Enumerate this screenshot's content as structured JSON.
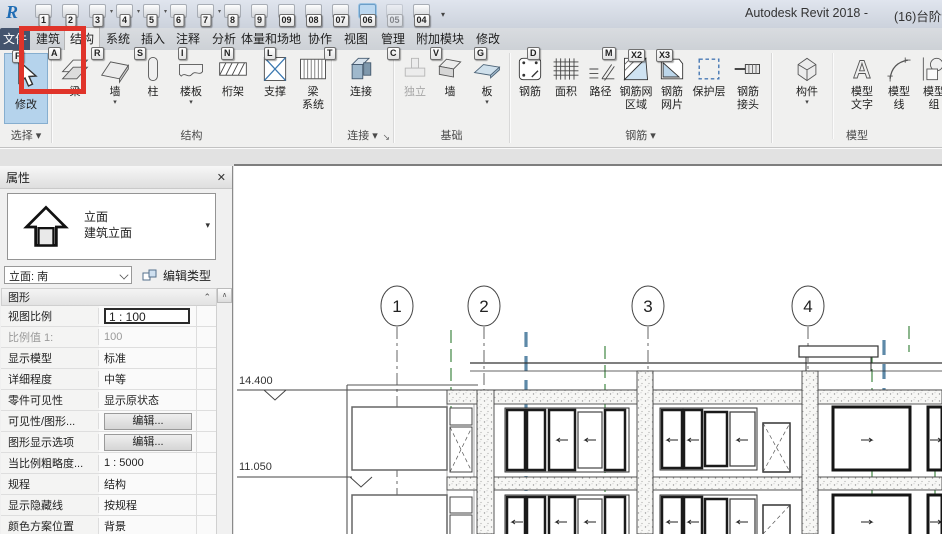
{
  "glyphs": {
    "dd": "▾",
    "up": "∧",
    "collapse": "⌃",
    "close": "✕",
    "launcher": "↘",
    "overflow": "▾"
  },
  "titlebar": {
    "app_title": "Autodesk Revit 2018 -",
    "doc_title": "(16)台阶制"
  },
  "qat": {
    "items": [
      {
        "key": "1"
      },
      {
        "key": "2"
      },
      {
        "key": "3"
      },
      {
        "key": "4"
      },
      {
        "key": "5"
      },
      {
        "key": "6"
      },
      {
        "key": "7"
      },
      {
        "key": "8"
      },
      {
        "key": "9"
      },
      {
        "key": "09"
      },
      {
        "key": "08"
      },
      {
        "key": "07"
      },
      {
        "key": "06"
      },
      {
        "key": "05"
      },
      {
        "key": "04"
      }
    ]
  },
  "tabs": [
    {
      "label": "文件",
      "key": "F"
    },
    {
      "label": "建筑",
      "key": "A"
    },
    {
      "label": "结构",
      "key": "R"
    },
    {
      "label": "系统",
      "key": "S"
    },
    {
      "label": "插入",
      "key": "I"
    },
    {
      "label": "注释",
      "key": "N"
    },
    {
      "label": "分析",
      "key": "L"
    },
    {
      "label": "体量和场地",
      "key": "T"
    },
    {
      "label": "协作",
      "key": "C"
    },
    {
      "label": "视图",
      "key": "V"
    },
    {
      "label": "管理",
      "key": "G"
    },
    {
      "label": "附加模块",
      "key": "D"
    },
    {
      "label": "修改",
      "key": "M"
    }
  ],
  "ribbon": {
    "extra_keytips": [
      "X2",
      "X3"
    ],
    "modify": "修改",
    "labels": {
      "select": "选择",
      "structure": "结构",
      "connection": "连接",
      "foundation": "基础",
      "rebar": "钢筋",
      "model": "模型"
    },
    "structure": [
      {
        "l1": "梁"
      },
      {
        "l1": "墙"
      },
      {
        "l1": "柱"
      },
      {
        "l1": "楼板"
      },
      {
        "l1": "桁架"
      },
      {
        "l1": "支撑"
      },
      {
        "l1": "梁",
        "l2": "系统"
      }
    ],
    "connection_btn": {
      "l1": "连接"
    },
    "foundation": [
      {
        "l1": "独立"
      },
      {
        "l1": "墙"
      },
      {
        "l1": "板"
      }
    ],
    "rebar": [
      {
        "l1": "钢筋"
      },
      {
        "l1": "面积"
      },
      {
        "l1": "路径"
      },
      {
        "l1": "钢筋网",
        "l2": "区域"
      },
      {
        "l1": "钢筋",
        "l2": "网片"
      },
      {
        "l1": "保护层"
      },
      {
        "l1": "钢筋",
        "l2": "接头"
      }
    ],
    "model": [
      {
        "l1": "构件"
      },
      {
        "l1": "模型",
        "l2": "文字"
      },
      {
        "l1": "模型",
        "l2": "线"
      },
      {
        "l1": "模型",
        "l2": "组"
      }
    ]
  },
  "properties": {
    "title": "属性",
    "type_selector": {
      "line1": "立面",
      "line2": "建筑立面"
    },
    "view_selector": "立面: 南",
    "edit_type": "编辑类型",
    "section": "图形",
    "rows": [
      {
        "label": "视图比例",
        "value": "1 : 100"
      },
      {
        "label": "比例值 1:",
        "value": "100"
      },
      {
        "label": "显示模型",
        "value": "标准"
      },
      {
        "label": "详细程度",
        "value": "中等"
      },
      {
        "label": "零件可见性",
        "value": "显示原状态"
      },
      {
        "label": "可见性/图形...",
        "value": "编辑..."
      },
      {
        "label": "图形显示选项",
        "value": "编辑..."
      },
      {
        "label": "当比例粗略度...",
        "value": "1 : 5000"
      },
      {
        "label": "规程",
        "value": "结构"
      },
      {
        "label": "显示隐藏线",
        "value": "按规程"
      },
      {
        "label": "颜色方案位置",
        "value": "背景"
      },
      {
        "label": "颜色方案",
        "value": "<无>"
      }
    ]
  },
  "canvas": {
    "grids": [
      "1",
      "2",
      "3",
      "4"
    ],
    "levels": [
      "14.400",
      "11.050"
    ]
  }
}
